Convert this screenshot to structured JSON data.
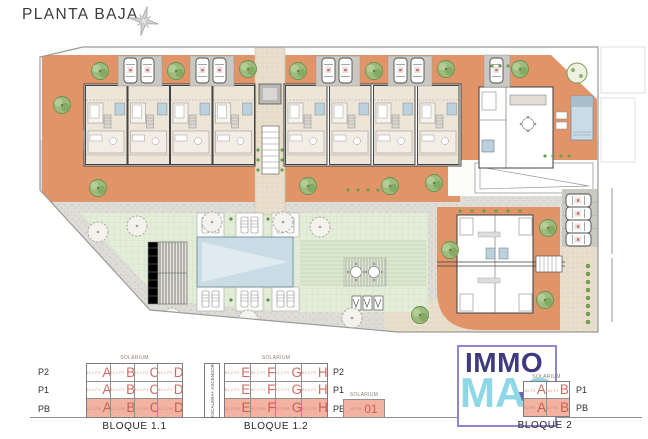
{
  "title": "PLANTA BAJA",
  "header": {
    "compass_icon": "north-compass-star"
  },
  "site_plan": {
    "type": "architectural-ground-floor-plan",
    "palette": {
      "terrace_orange": "#e09468",
      "interior_beige": "#ece5d8",
      "lawn_green": "#e3edd9",
      "pool_blue": "#c9dbe4",
      "path_gray": "#dddcd6",
      "cobble_beige": "#eae1cf",
      "tree_green": "#9cbb7c",
      "highlight_salmon": "#f3b3a3"
    }
  },
  "legend": {
    "solarium_label": "SOLARIUM",
    "stairs_label": "ESCALERA+ ASCENSOR",
    "bloque11": {
      "title": "BLOQUE 1.1",
      "floors": [
        "P2",
        "P1",
        "PB"
      ],
      "cells": [
        [
          {
            "sub": "B1.1 P2",
            "u": "A"
          },
          {
            "sub": "B1.1 P2",
            "u": "B"
          },
          {
            "sub": "B1.1 P2",
            "u": "C"
          },
          {
            "sub": "B1.1 P2",
            "u": "D"
          }
        ],
        [
          {
            "sub": "B1.1 P1",
            "u": "A"
          },
          {
            "sub": "B1.1 P1",
            "u": "B"
          },
          {
            "sub": "B1.1 P1",
            "u": "C"
          },
          {
            "sub": "B1.1 P1",
            "u": "D"
          }
        ],
        [
          {
            "sub": "B1.1 PB",
            "u": "A"
          },
          {
            "sub": "B1.1 PB",
            "u": "B"
          },
          {
            "sub": "B1.1 PB",
            "u": "C"
          },
          {
            "sub": "B1.1 PB",
            "u": "D"
          }
        ]
      ]
    },
    "bloque12": {
      "title": "BLOQUE 1.2",
      "floors": [
        "P2",
        "P1",
        "PB"
      ],
      "cells": [
        [
          {
            "sub": "B1.2 P2",
            "u": "E"
          },
          {
            "sub": "B1.2 P2",
            "u": "F"
          },
          {
            "sub": "B1.2 P2",
            "u": "G"
          },
          {
            "sub": "B1.2 P2",
            "u": "H"
          }
        ],
        [
          {
            "sub": "B1.2 P1",
            "u": "E"
          },
          {
            "sub": "B1.2 P1",
            "u": "F"
          },
          {
            "sub": "B1.2 P1",
            "u": "G"
          },
          {
            "sub": "B1.2 P1",
            "u": "H"
          }
        ],
        [
          {
            "sub": "B1.2 PB",
            "u": "E"
          },
          {
            "sub": "B1.2 PB",
            "u": "F"
          },
          {
            "sub": "B1.2 PB",
            "u": "G"
          },
          {
            "sub": "B1.2 PB",
            "u": "H"
          }
        ]
      ]
    },
    "solarium_unit": {
      "label": "SOLARIUM",
      "sub": "B2 PB",
      "u": "01"
    },
    "bloque2": {
      "title": "BLOQUE 2",
      "floors": [
        "P1",
        "PB"
      ],
      "cells": [
        [
          {
            "sub": "B2 P1",
            "u": "A"
          },
          {
            "sub": "B2 P1",
            "u": "B"
          }
        ],
        [
          {
            "sub": "B2 PB",
            "u": "A"
          },
          {
            "sub": "B2 PB",
            "u": "B"
          }
        ]
      ]
    },
    "logo": {
      "line1": "IMMO",
      "line2": "MAS",
      "plus_icon": "plus"
    }
  }
}
